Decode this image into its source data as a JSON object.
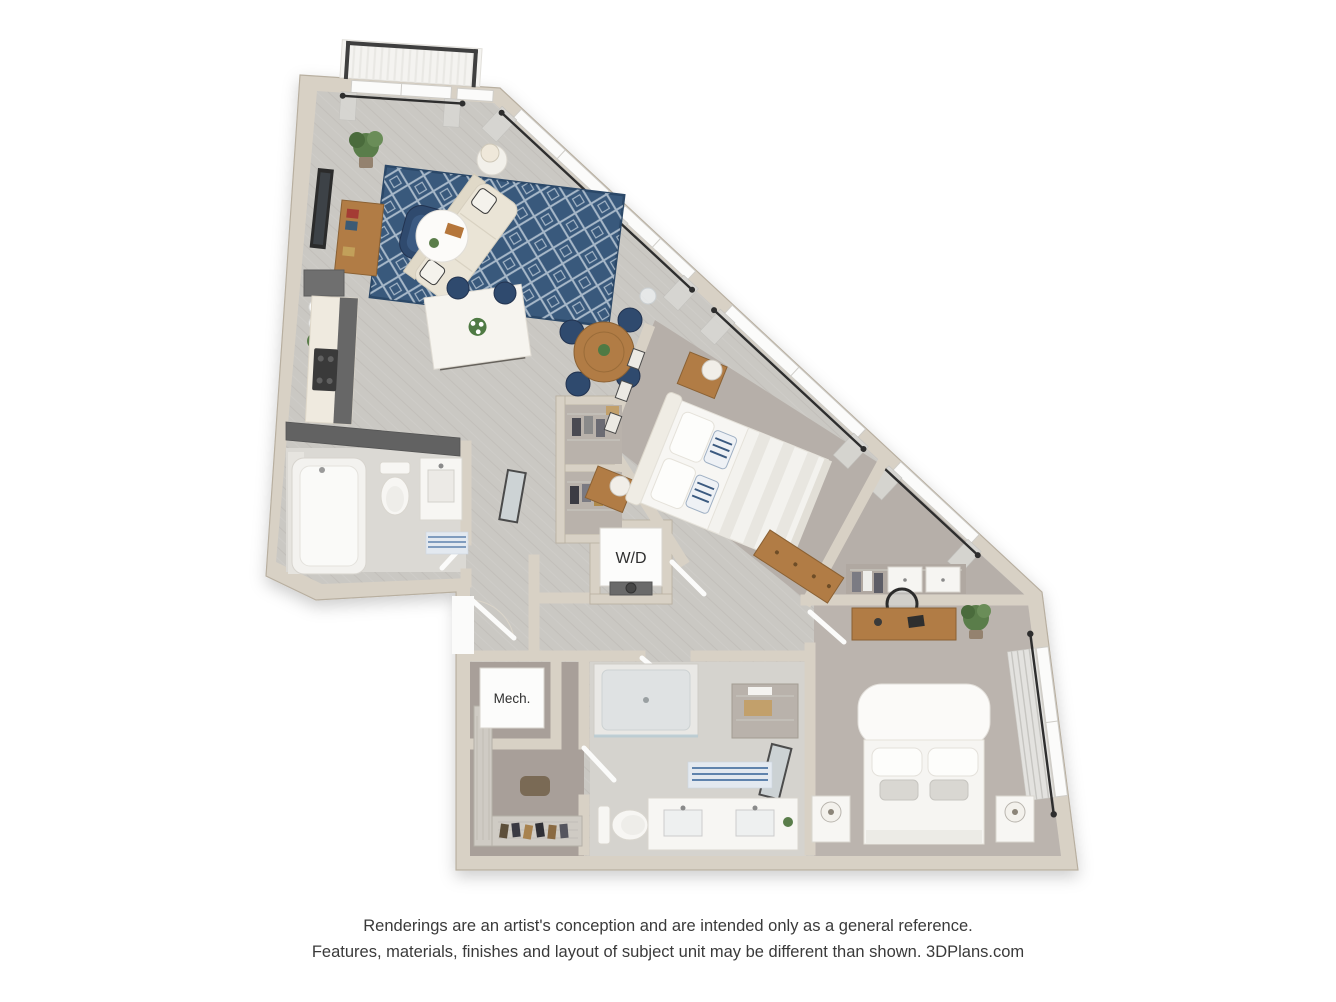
{
  "page": {
    "background": "#ffffff",
    "width": 1336,
    "height": 1002
  },
  "floor_plan": {
    "labels": {
      "washer_dryer": "W/D",
      "mechanical": "Mech."
    }
  },
  "disclaimer": {
    "line1": "Renderings are an artist's conception and are intended only as a general reference.",
    "line2": "Features, materials, finishes and layout of subject unit may be different than shown. 3DPlans.com"
  },
  "palette": {
    "wall": "#d8d1c5",
    "wall_edge": "#b8afa0",
    "wall_dark": "#626262",
    "floor_wood": "#cac8c3",
    "plank_line": "#b7b4ae",
    "carpet_primary": "#b6afa9",
    "carpet_secondary": "#bbb4ae",
    "carpet_closet": "#a89f99",
    "bath_floor": "#dbd9d4",
    "navy": "#2f4a6e",
    "rug_navy": "#39597c",
    "rug_pattern": "#c3d0dc",
    "sofa_cream": "#eae4d6",
    "wood": "#b17c45",
    "wood_dark": "#8a6134",
    "fixture_white": "#f7f6f3",
    "window_white": "#fbfbfa",
    "curtain": "#d7d6d2",
    "rod": "#2e2e2e",
    "stripe_blue": "#5f83ad",
    "plant_green": "#5a7d4a",
    "label_text": "#2f2f2f",
    "disclaimer_text": "#3a3a3a"
  }
}
